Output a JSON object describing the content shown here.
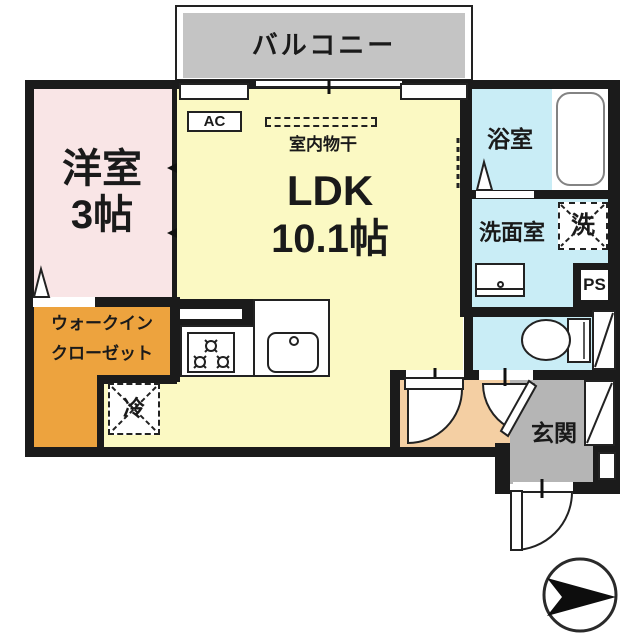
{
  "floorplan": {
    "balcony": {
      "label": "バルコニー"
    },
    "rooms": {
      "western_room": {
        "name": "洋室",
        "size": "3帖"
      },
      "ldk": {
        "name": "LDK",
        "size": "10.1帖"
      },
      "walk_in_closet": {
        "line1": "ウォークイン",
        "line2": "クローゼット"
      },
      "bathroom": {
        "name": "浴室"
      },
      "washroom": {
        "name": "洗面室"
      },
      "entrance": {
        "name": "玄関"
      }
    },
    "fixtures": {
      "air_conditioner": "AC",
      "indoor_drying": "室内物干",
      "refrigerator": "冷",
      "washing_machine": "洗",
      "pipe_space": "PS"
    },
    "colors": {
      "wall": "#1b1b1b",
      "balcony": "#c4c4c4",
      "western_room": "#f9e5e6",
      "ldk": "#fbf9c3",
      "closet": "#eda33e",
      "wet_area": "#c9edf6",
      "entrance_floor": "#b5b5b5",
      "hall_floor": "#f4cfa3"
    }
  }
}
